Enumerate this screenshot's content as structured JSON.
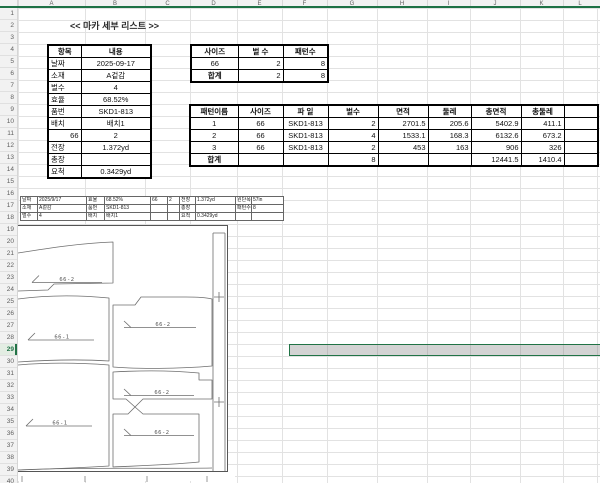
{
  "sheet": {
    "title": "<< 마카 세부 리스트 >>",
    "column_headers": [
      "A",
      "B",
      "C",
      "D",
      "E",
      "F",
      "G",
      "H",
      "I",
      "J",
      "K",
      "L"
    ],
    "row_count": 40,
    "selected_row": "29"
  },
  "info_table": {
    "headers": [
      "항목",
      "내용"
    ],
    "rows": [
      [
        "날짜",
        "2025-09-17"
      ],
      [
        "소재",
        "A겉감"
      ],
      [
        "벌수",
        "4"
      ],
      [
        "효율",
        "68.52%"
      ],
      [
        "품번",
        "SKD1-813"
      ],
      [
        "배치",
        "배치1"
      ],
      [
        "66",
        "2"
      ],
      [
        "전장",
        "1.372yd"
      ],
      [
        "총장",
        ""
      ],
      [
        "요척",
        "0.3429yd"
      ]
    ]
  },
  "size_table": {
    "headers": [
      "사이즈",
      "벌 수",
      "패턴수"
    ],
    "rows": [
      [
        "66",
        "2",
        "8"
      ],
      [
        "합계",
        "2",
        "8"
      ]
    ]
  },
  "pattern_table": {
    "headers": [
      "패턴이름",
      "사이즈",
      "파 일",
      "벌수",
      "면적",
      "둘레",
      "총면적",
      "총둘레"
    ],
    "rows": [
      [
        "1",
        "66",
        "SKD1-813",
        "2",
        "2701.5",
        "205.6",
        "5402.9",
        "411.1"
      ],
      [
        "2",
        "66",
        "SKD1-813",
        "4",
        "1533.1",
        "168.3",
        "6132.6",
        "673.2"
      ],
      [
        "3",
        "66",
        "SKD1-813",
        "2",
        "453",
        "163",
        "906",
        "326"
      ]
    ],
    "total_row": [
      "합계",
      "8",
      "12441.5",
      "1410.4"
    ]
  },
  "marker_image": {
    "header_rows": [
      [
        "날짜",
        "2025/9/17",
        "효율",
        "68.52%",
        "66",
        "2",
        "전장",
        "1.372yd",
        "원단폭",
        "57in"
      ],
      [
        "소재",
        "A겉감",
        "품번",
        "SKD1-813",
        "",
        "",
        "총장",
        "",
        "패턴수",
        "8"
      ],
      [
        "벌수",
        "4",
        "배치",
        "배치1",
        "",
        "",
        "요척",
        "0.3429yd",
        "",
        ""
      ]
    ],
    "piece_labels": [
      "66-2",
      "66-1",
      "66-2",
      "66-1",
      "66-2",
      "66-2"
    ]
  },
  "colors": {
    "accent_green": "#217346",
    "header_underline_green": "#1E7145",
    "selection_fill_gray": "#CFCFCF",
    "gridline_gray": "#E2E2E2"
  }
}
